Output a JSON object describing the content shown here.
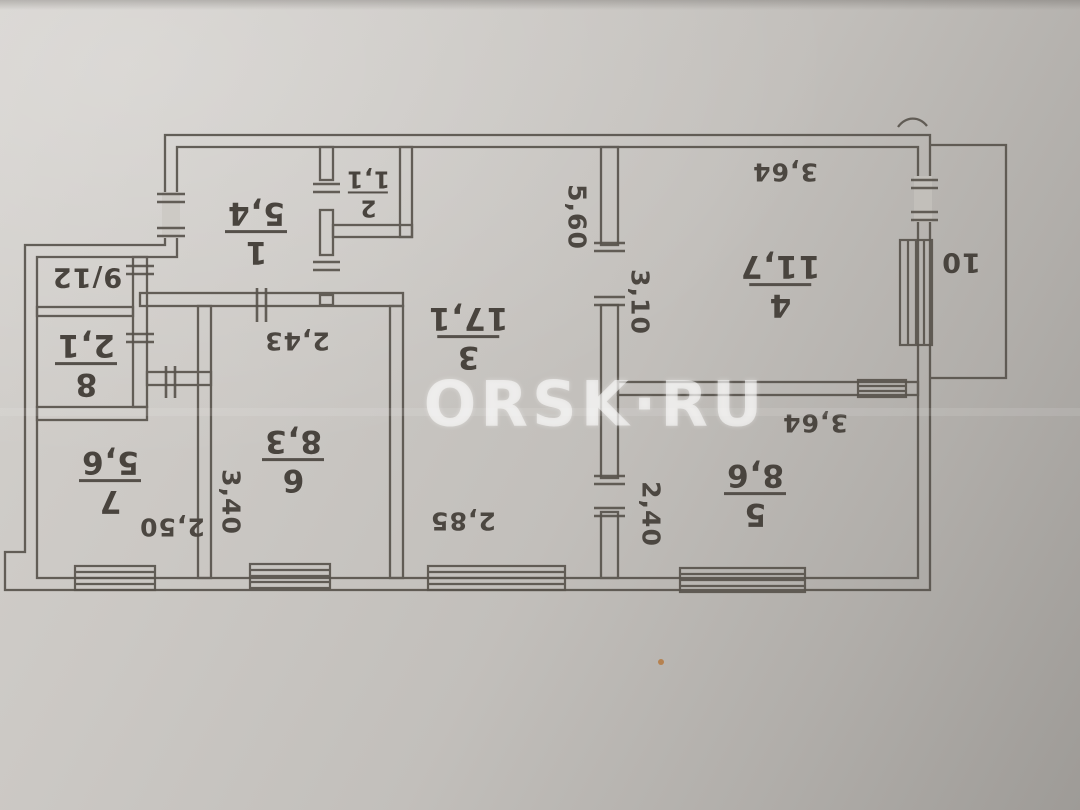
{
  "watermark": {
    "text": "ORSK·RU"
  },
  "colors": {
    "paper": "#c8c5c0",
    "ink": "#57524c",
    "label_text": "#49443e",
    "watermark_color": "rgba(255,255,255,0.55)"
  },
  "rooms": [
    {
      "number": "1",
      "area": "5,4"
    },
    {
      "number": "2",
      "area": "1,1"
    },
    {
      "number": "3",
      "area": "17,1"
    },
    {
      "number": "4",
      "area": "11,7"
    },
    {
      "number": "5",
      "area": "8,6"
    },
    {
      "number": "6",
      "area": "8,3"
    },
    {
      "number": "7",
      "area": "5,6"
    },
    {
      "number": "8",
      "area": "2,1"
    }
  ],
  "annotations": {
    "closet_label": "9/12",
    "balcony_label": "10"
  },
  "dimensions": [
    {
      "value": "5,60",
      "orientation": "vertical"
    },
    {
      "value": "2,85",
      "orientation": "horizontal"
    },
    {
      "value": "3,10",
      "orientation": "vertical"
    },
    {
      "value": "2,40",
      "orientation": "vertical"
    },
    {
      "value": "3,64",
      "orientation": "horizontal"
    },
    {
      "value": "3,64",
      "orientation": "horizontal"
    },
    {
      "value": "3,40",
      "orientation": "vertical"
    },
    {
      "value": "2,43",
      "orientation": "horizontal"
    },
    {
      "value": "2,50",
      "orientation": "horizontal"
    }
  ]
}
